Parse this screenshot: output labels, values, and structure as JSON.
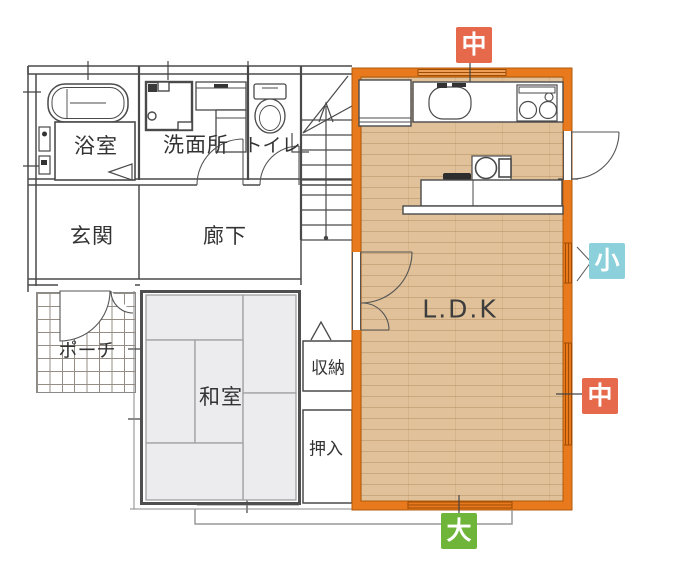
{
  "plan": {
    "rooms": {
      "bath": {
        "label": "浴室"
      },
      "washroom": {
        "label": "洗面所"
      },
      "toilet": {
        "label": "トイレ"
      },
      "entrance": {
        "label": "玄関"
      },
      "hallway": {
        "label": "廊下"
      },
      "porch": {
        "label": "ポーチ"
      },
      "japanese_room": {
        "label": "和室"
      },
      "storage": {
        "label": "収納"
      },
      "closet": {
        "label": "押入"
      },
      "ldk": {
        "label": "L.D.K"
      }
    },
    "window_badges": {
      "top_center": {
        "label": "中",
        "color": "#e5694a"
      },
      "right_upper": {
        "label": "小",
        "color": "#8bd0da"
      },
      "right_lower": {
        "label": "中",
        "color": "#e5694a"
      },
      "bottom": {
        "label": "大",
        "color": "#6fb53a"
      }
    },
    "colors": {
      "ldk_highlight_wall": "#e8791d",
      "ldk_wall_edge": "#b05a0c",
      "wood_floor": "#e0c199",
      "tatami": "#ececef",
      "wall_line": "#4a4a4a"
    }
  }
}
